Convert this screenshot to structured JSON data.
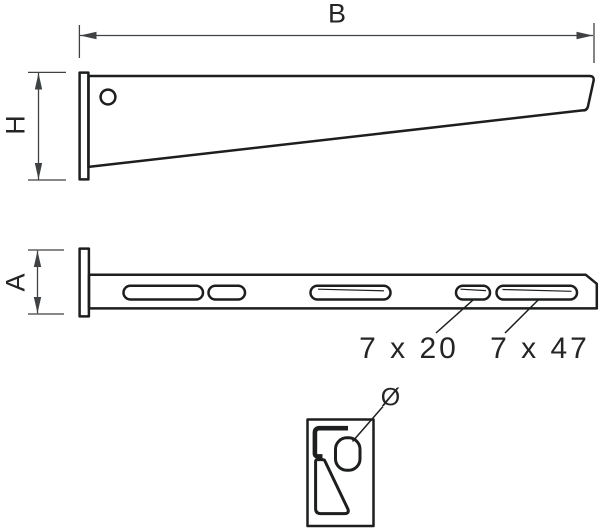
{
  "drawing": {
    "kind": "technical line drawing, wall bracket with mounting plate, three views"
  },
  "labels": {
    "width": "B",
    "height": "H",
    "depth": "A",
    "slot_small": "7 x 20",
    "slot_large": "7 x 47",
    "diameter": "Ø"
  },
  "colors": {
    "c-outline": "#1c1e1f",
    "c-dim": "#3f4244",
    "c-text": "#232526",
    "c-bg": "#ffffff"
  }
}
